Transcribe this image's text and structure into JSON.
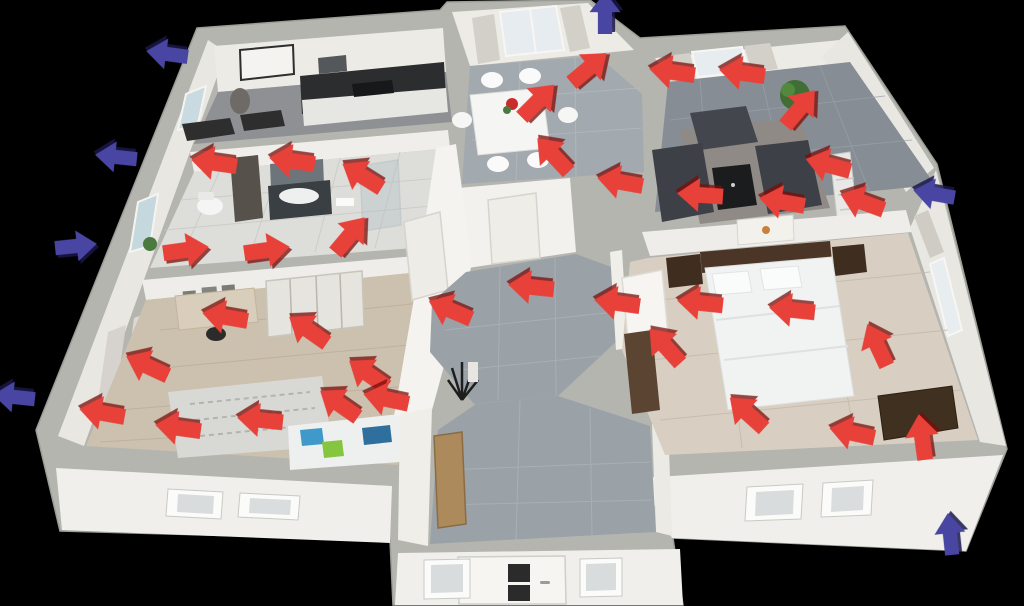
{
  "scene": {
    "background_color": "#000000"
  },
  "arrows": {
    "heat_color": "#e8413a",
    "cold_color": "#4945a2",
    "heat": [
      {
        "x": 214,
        "y": 163,
        "rot": 188
      },
      {
        "x": 292,
        "y": 161,
        "rot": 188
      },
      {
        "x": 362,
        "y": 176,
        "rot": 212
      },
      {
        "x": 186,
        "y": 250,
        "rot": 352
      },
      {
        "x": 267,
        "y": 250,
        "rot": 352
      },
      {
        "x": 350,
        "y": 235,
        "rot": 310
      },
      {
        "x": 538,
        "y": 101,
        "rot": 315
      },
      {
        "x": 589,
        "y": 68,
        "rot": 320
      },
      {
        "x": 553,
        "y": 155,
        "rot": 227
      },
      {
        "x": 672,
        "y": 72,
        "rot": 188
      },
      {
        "x": 742,
        "y": 73,
        "rot": 188
      },
      {
        "x": 800,
        "y": 108,
        "rot": 310
      },
      {
        "x": 828,
        "y": 165,
        "rot": 195
      },
      {
        "x": 700,
        "y": 195,
        "rot": 184
      },
      {
        "x": 782,
        "y": 202,
        "rot": 190
      },
      {
        "x": 862,
        "y": 202,
        "rot": 200
      },
      {
        "x": 620,
        "y": 182,
        "rot": 190
      },
      {
        "x": 531,
        "y": 287,
        "rot": 186
      },
      {
        "x": 450,
        "y": 310,
        "rot": 203
      },
      {
        "x": 617,
        "y": 303,
        "rot": 188
      },
      {
        "x": 665,
        "y": 346,
        "rot": 228
      },
      {
        "x": 700,
        "y": 303,
        "rot": 186
      },
      {
        "x": 792,
        "y": 310,
        "rot": 186
      },
      {
        "x": 877,
        "y": 345,
        "rot": 245
      },
      {
        "x": 747,
        "y": 413,
        "rot": 222
      },
      {
        "x": 852,
        "y": 433,
        "rot": 192
      },
      {
        "x": 922,
        "y": 437,
        "rot": 262
      },
      {
        "x": 225,
        "y": 317,
        "rot": 190
      },
      {
        "x": 308,
        "y": 330,
        "rot": 215
      },
      {
        "x": 147,
        "y": 366,
        "rot": 205
      },
      {
        "x": 368,
        "y": 374,
        "rot": 215
      },
      {
        "x": 339,
        "y": 404,
        "rot": 215
      },
      {
        "x": 386,
        "y": 399,
        "rot": 192
      },
      {
        "x": 102,
        "y": 413,
        "rot": 190
      },
      {
        "x": 178,
        "y": 428,
        "rot": 188
      },
      {
        "x": 260,
        "y": 420,
        "rot": 186
      }
    ],
    "cold": [
      {
        "x": 167,
        "y": 54,
        "rot": 188
      },
      {
        "x": 116,
        "y": 157,
        "rot": 186
      },
      {
        "x": 76,
        "y": 246,
        "rot": 354
      },
      {
        "x": 14,
        "y": 397,
        "rot": 186
      },
      {
        "x": 605,
        "y": 13,
        "rot": 270
      },
      {
        "x": 934,
        "y": 194,
        "rot": 190
      },
      {
        "x": 950,
        "y": 534,
        "rot": 264
      }
    ]
  }
}
